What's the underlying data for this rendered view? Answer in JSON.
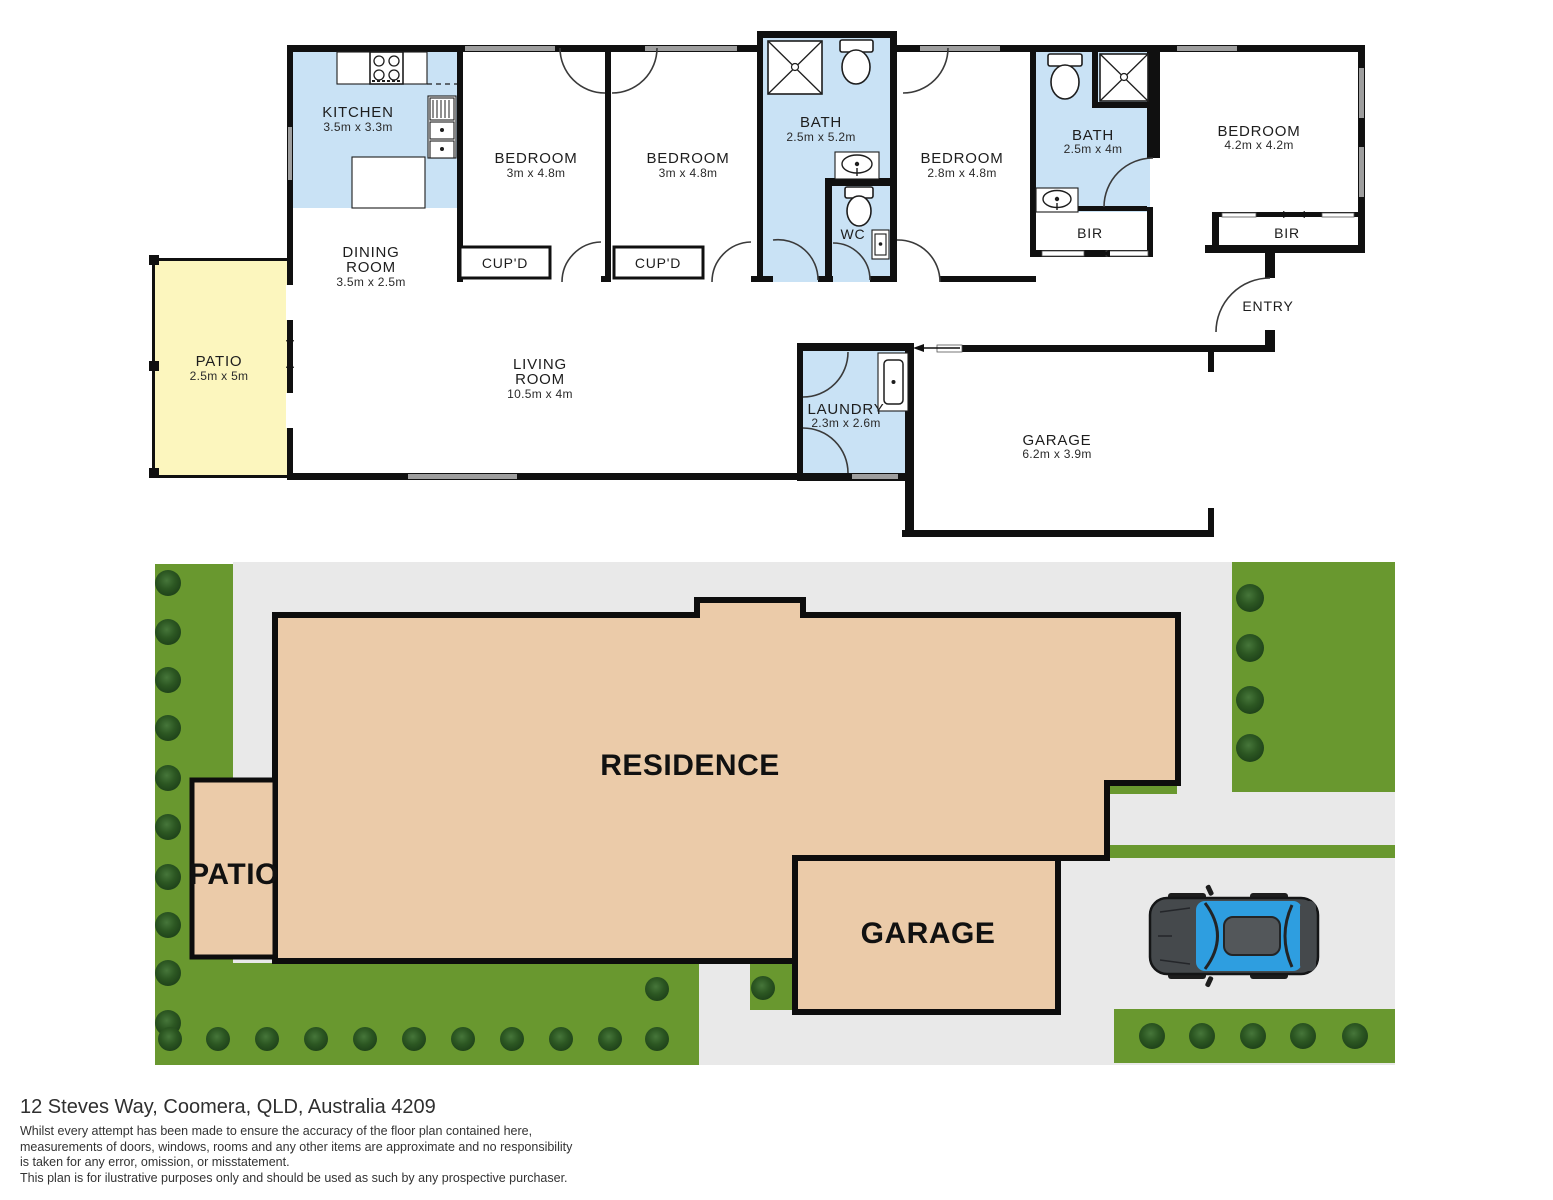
{
  "floor_plan": {
    "kitchen": {
      "name": "KITCHEN",
      "dims": "3.5m x 3.3m"
    },
    "dining": {
      "name1": "DINING",
      "name2": "ROOM",
      "dims": "3.5m x 2.5m"
    },
    "bedroom1": {
      "name": "BEDROOM",
      "dims": "3m x 4.8m"
    },
    "bedroom2": {
      "name": "BEDROOM",
      "dims": "3m x 4.8m"
    },
    "bedroom3": {
      "name": "BEDROOM",
      "dims": "2.8m x 4.8m"
    },
    "bedroom4": {
      "name": "BEDROOM",
      "dims": "4.2m x 4.2m"
    },
    "bath1": {
      "name": "BATH",
      "dims": "2.5m x 5.2m"
    },
    "bath2": {
      "name": "BATH",
      "dims": "2.5m x 4m"
    },
    "wc": {
      "name": "WC"
    },
    "laundry": {
      "name": "LAUNDRY",
      "dims": "2.3m x 2.6m"
    },
    "garage": {
      "name": "GARAGE",
      "dims": "6.2m x 3.9m"
    },
    "living": {
      "name1": "LIVING",
      "name2": "ROOM",
      "dims": "10.5m x 4m"
    },
    "patio": {
      "name": "PATIO",
      "dims": "2.5m x 5m"
    },
    "cupboard1": {
      "name": "CUP'D"
    },
    "cupboard2": {
      "name": "CUP'D"
    },
    "bir1": {
      "name": "BIR"
    },
    "bir2": {
      "name": "BIR"
    },
    "entry": {
      "name": "ENTRY"
    }
  },
  "site_plan": {
    "residence": "RESIDENCE",
    "garage": "GARAGE",
    "patio": "PATIO"
  },
  "footer": {
    "address": "12 Steves Way, Coomera, QLD, Australia 4209",
    "disclaimer": [
      "Whilst every attempt has been made to ensure the accuracy of the floor plan contained here,",
      "measurements of doors, windows, rooms and any other items are approximate and no responsibility",
      "is taken for any error, omission, or misstatement.",
      "This plan is for ilustrative purposes only and should be used as such by any prospective purchaser."
    ]
  },
  "colors": {
    "wet_area_blue": "#c9e2f5",
    "patio_yellow": "#fcf6be",
    "wall_black": "#101010",
    "residence_tan": "#ebcba9",
    "grass_green": "#69982f",
    "bush_green": "#2c5722",
    "driveway_gray": "#e9e9e9",
    "car_blue": "#2e9ee0"
  }
}
